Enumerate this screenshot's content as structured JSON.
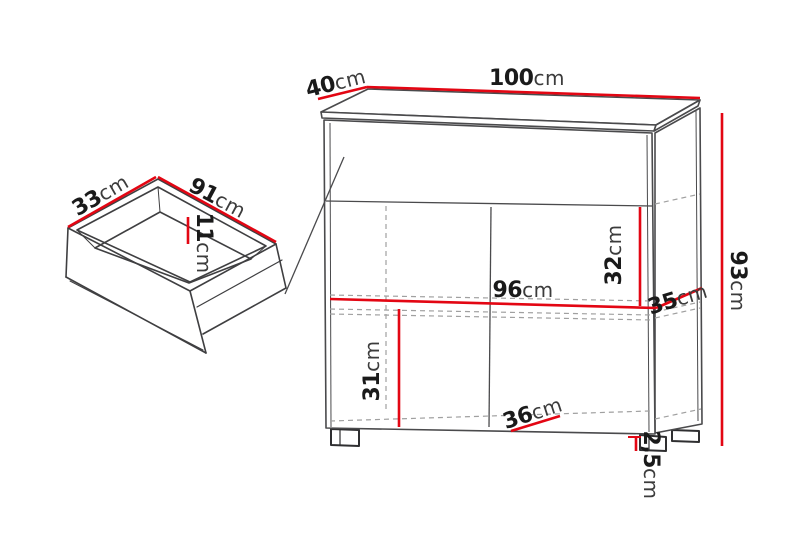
{
  "colors": {
    "dimension_accent": "#e30613",
    "outline": "#4a4a4c",
    "hidden_edge": "#a0a0a0",
    "label_value": "#1a1a1a",
    "label_unit": "#3c3c3c",
    "background": "#ffffff"
  },
  "dims": {
    "top_depth": {
      "value": "40",
      "unit": "cm"
    },
    "top_width": {
      "value": "100",
      "unit": "cm"
    },
    "drawer_depth": {
      "value": "33",
      "unit": "cm"
    },
    "drawer_width": {
      "value": "91",
      "unit": "cm"
    },
    "drawer_inner_height": {
      "value": "11",
      "unit": "cm"
    },
    "upper_section_height": {
      "value": "32",
      "unit": "cm"
    },
    "inner_width": {
      "value": "96",
      "unit": "cm"
    },
    "side_inner_depth": {
      "value": "35",
      "unit": "cm"
    },
    "lower_section_height": {
      "value": "31",
      "unit": "cm"
    },
    "bottom_inner_depth": {
      "value": "36",
      "unit": "cm"
    },
    "foot_height": {
      "value": "2,5",
      "unit": "cm"
    },
    "total_height": {
      "value": "93",
      "unit": "cm"
    }
  }
}
